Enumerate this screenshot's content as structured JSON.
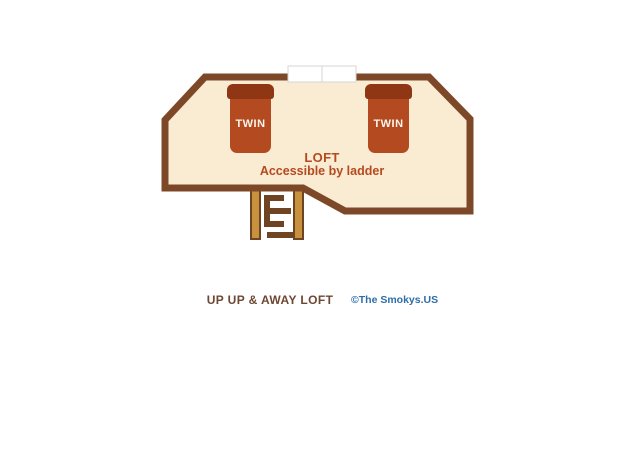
{
  "colors": {
    "wall": "#7d4827",
    "room": "#f9ecd3",
    "bed": "#b44a1f",
    "bedhead": "#8f3614",
    "rail": "#c8913e",
    "dark": "#6e4423",
    "brick": "#b5491f",
    "title": "#6e4733",
    "credit": "#2e6da8",
    "window": "#ffffff",
    "window_border": "#d8d5d0"
  },
  "floorplan": {
    "room_label": "LOFT",
    "room_sublabel": "Accessible by ladder",
    "beds": [
      {
        "label": "TWIN"
      },
      {
        "label": "TWIN"
      }
    ]
  },
  "footer": {
    "title": "UP UP & AWAY LOFT",
    "credit": "©The Smokys.US"
  }
}
